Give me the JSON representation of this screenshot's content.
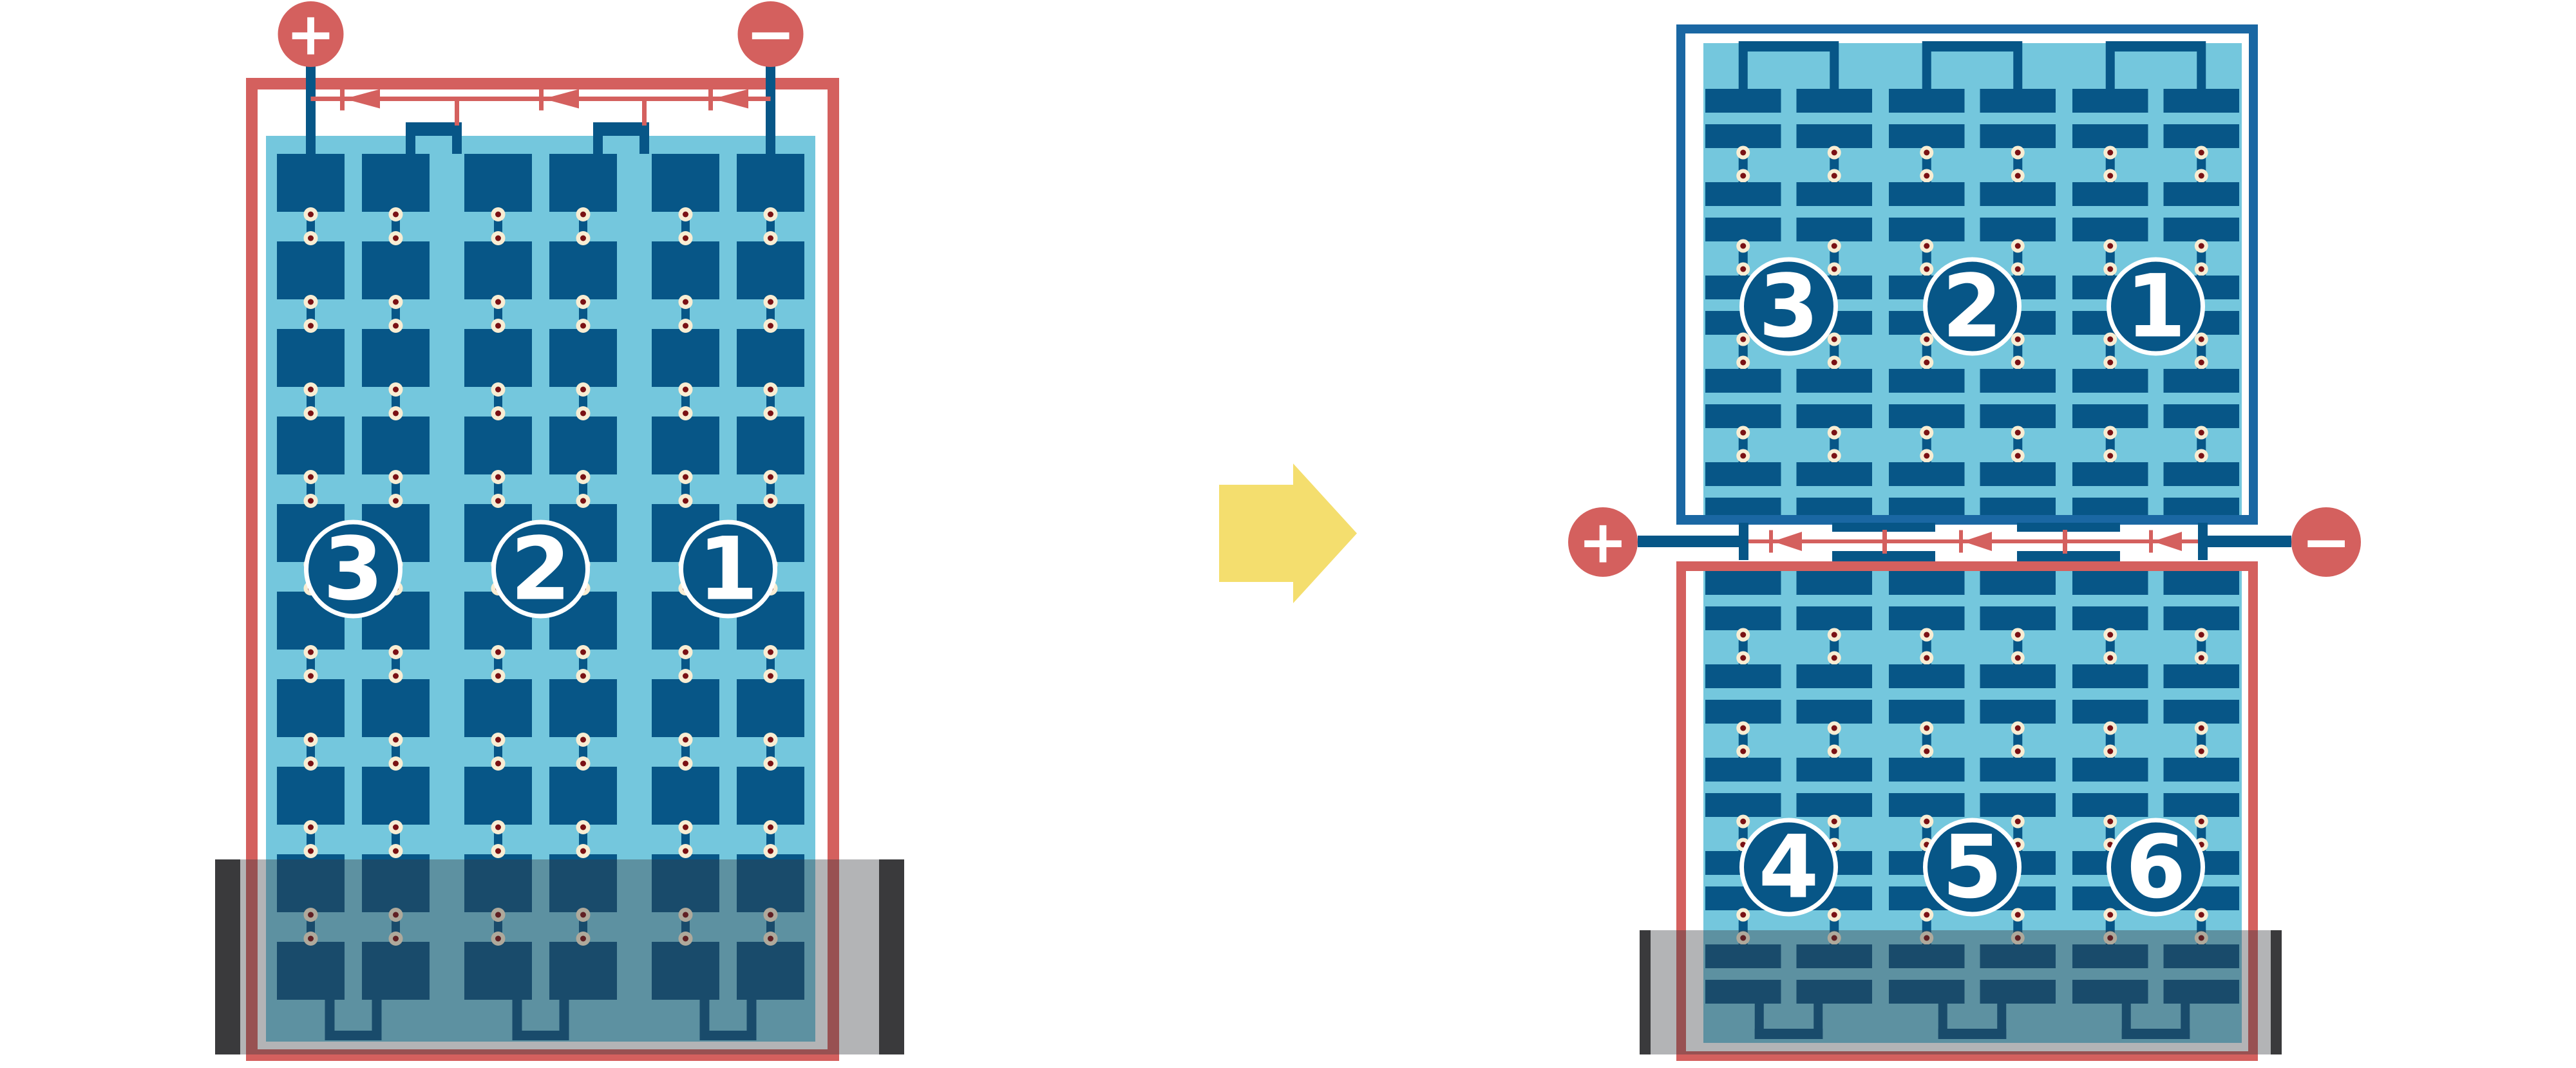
{
  "colors": {
    "background": "#ffffff",
    "wire_red": "#d4605e",
    "cell_blue": "#075687",
    "frame_blue": "#1a67a3",
    "panel_blue": "#74c7dd",
    "solder_cream": "#f8edd3",
    "solder_maroon": "#7a1114",
    "shadow_overlay": "rgba(56,58,62,0.38)",
    "shadow_cap": "#3a3a3c",
    "arrow_yellow": "#f4de6e",
    "label_white": "#ffffff"
  },
  "left_module": {
    "positive": "+",
    "negative": "−",
    "substrings": [
      "3",
      "2",
      "1"
    ],
    "cell_rows": 10,
    "cell_columns": 6,
    "bypass_diodes": 3,
    "shaded_bottom": true
  },
  "transition_arrow": {
    "direction": "right"
  },
  "right_top_module": {
    "substrings": [
      "3",
      "2",
      "1"
    ],
    "cell_row_pairs": 5,
    "cell_columns": 6
  },
  "junction_bus": {
    "positive": "+",
    "negative": "−",
    "bypass_diodes": 3
  },
  "right_bottom_module": {
    "substrings": [
      "4",
      "5",
      "6"
    ],
    "cell_row_pairs": 5,
    "cell_columns": 6,
    "shaded_bottom": true
  }
}
